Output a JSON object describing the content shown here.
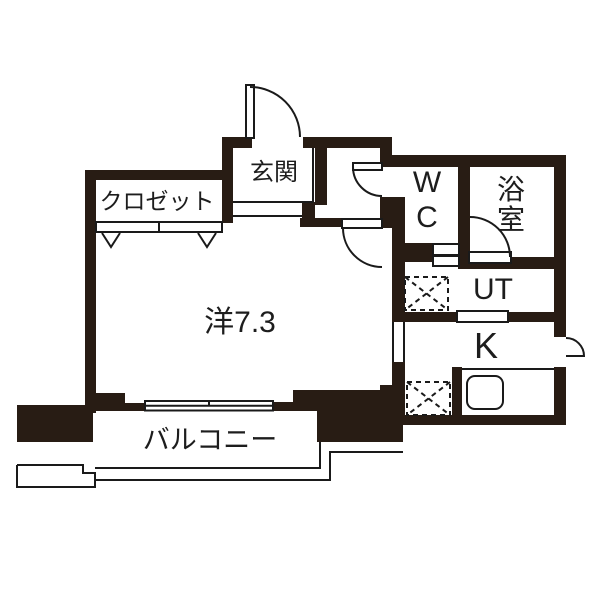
{
  "colors": {
    "wall": "#281c14",
    "line": "#1a1a1a",
    "bg": "#ffffff"
  },
  "rooms": {
    "entrance": {
      "label": "玄関"
    },
    "closet": {
      "label": "クロゼット"
    },
    "wc": {
      "line1": "W",
      "line2": "C"
    },
    "bathroom": {
      "char1": "浴",
      "char2": "室"
    },
    "utility": {
      "label": "UT"
    },
    "kitchen": {
      "label": "K"
    },
    "western_room": {
      "label": "洋7.3"
    },
    "balcony": {
      "label": "バルコニー"
    }
  }
}
